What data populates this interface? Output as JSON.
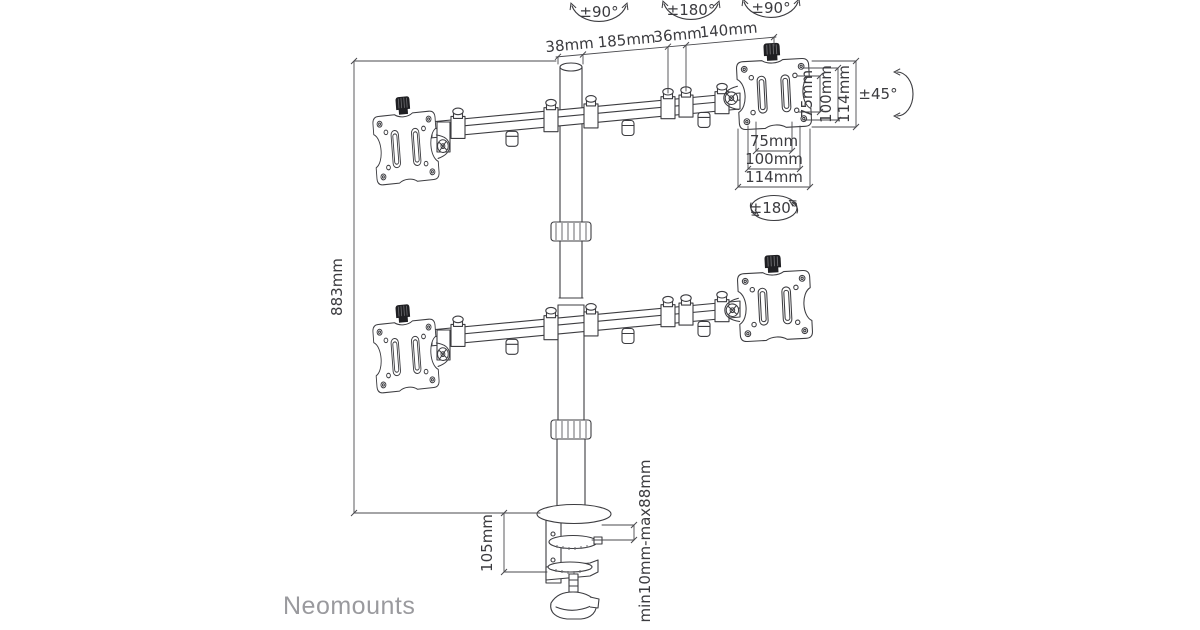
{
  "page": {
    "background": "#ffffff",
    "description": "Technical line drawing of a quad monitor desk mount with dimensions"
  },
  "brand": {
    "logo_text": "Neomounts",
    "logo_color": "#9a9a9e"
  },
  "colors": {
    "line": "#3c3c40",
    "dimension_line": "#4a4a4e",
    "text": "#3b3b3f",
    "knob_fill": "#1f1f22",
    "background": "#ffffff"
  },
  "dimensions": {
    "pole_diameter": "38mm",
    "arm_segment_inner": "185mm",
    "joint_width": "36mm",
    "arm_segment_outer": "140mm",
    "column_height": "883mm",
    "clamp_body_height": "105mm",
    "clamp_range": "min10mm-max88mm",
    "vesa_vertical": {
      "inner": "75mm",
      "middle": "100mm",
      "outer": "114mm"
    },
    "vesa_horizontal": {
      "inner": "75mm",
      "middle": "100mm",
      "outer": "114mm"
    }
  },
  "rotations": {
    "pole_swivel": "±90°",
    "arm_swivel": "±180°",
    "head_swivel": "±90°",
    "head_tilt": "±45°",
    "screen_rotation": "±180°"
  }
}
